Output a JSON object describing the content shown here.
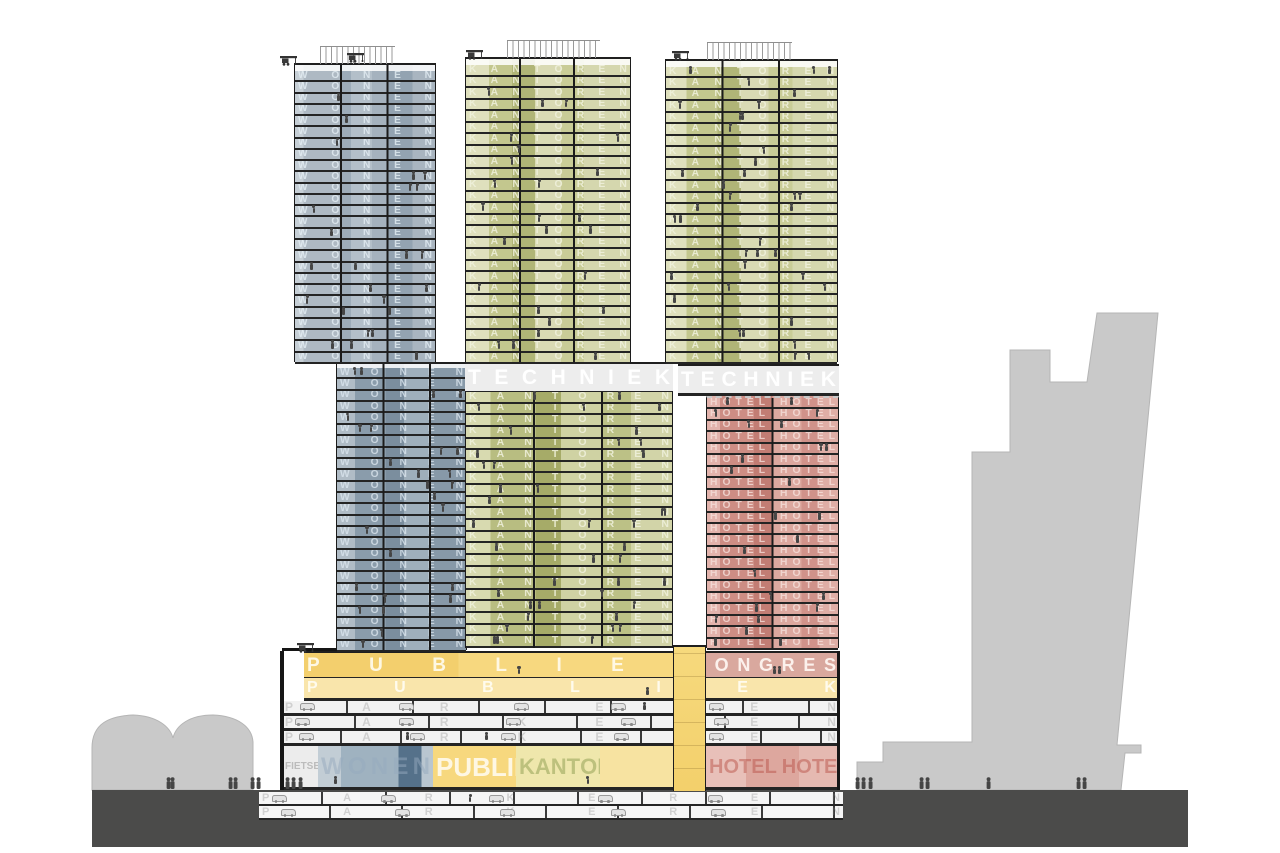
{
  "drawing": {
    "type": "architectural cross-section",
    "description": "Section through three-tower building on shared plinth with program labels"
  },
  "labels": {
    "wonen": "WONEN",
    "kantoren": "KANTOREN",
    "hotel": "HOTEL HOTEL",
    "techniek": "TECHNIEK",
    "publiek": "PUBLIEK",
    "congres": "CONGRES",
    "parkeren": "PARKEREN",
    "fietsen": "FIETSEN"
  },
  "colors": {
    "wonen_blue": "#aeb9c3",
    "kantoren_olive": "#c3c78e",
    "hotel_red": "#cd8d84",
    "techniek_grey": "#ededed",
    "publiek_yellow": "#f5d478",
    "congres_pink": "#d9a89e",
    "parking_grey": "#f2f2f2",
    "ground_dark": "#4b4b4a",
    "silhouette": "#c9c9c9",
    "figure": "#454545",
    "slab": "#242424"
  },
  "background": {
    "left_path": "M92,790 L92,748 C92,723 110,716 133,715 C158,716 170,727 173,738 C176,725 190,715 213,715 C238,716 252,727 253,742 L253,790 Z",
    "right_path": "M1010,350 L1050,350 L1050,382 L1087,382 L1097,313 L1158,313 L1117,745 L1141,745 L1141,753 L1125,753 L1121,790 L857,790 L857,762 L883,762 L883,742 L972,742 L972,452 L1010,452 Z"
  },
  "zones": [
    {
      "name": "ground-mass",
      "x": 92,
      "y": 790,
      "w": 1096,
      "h": 57,
      "bg": "#4b4b4a"
    },
    {
      "name": "basement-level-1",
      "x": 259,
      "y": 792,
      "w": 584,
      "h": 14,
      "floors": 1,
      "slab": 2,
      "bg": "repeating-linear-gradient(90deg,transparent 0 62px,#3a3a3a 62px 64px),linear-gradient(#f5f5f5,#f5f5f5)",
      "label": "parkeren",
      "fs": 11,
      "letterColor": "rgba(130,130,130,0.32)",
      "figMax": 1,
      "cars": true
    },
    {
      "name": "basement-level-2",
      "x": 259,
      "y": 806,
      "w": 584,
      "h": 14,
      "floors": 1,
      "slab": 2,
      "bg": "repeating-linear-gradient(90deg,transparent 0 70px,#3a3a3a 70px 72px),linear-gradient(#f5f5f5,#f5f5f5)",
      "label": "parkeren",
      "fs": 11,
      "letterColor": "rgba(130,130,130,0.32)",
      "figMax": 1,
      "cars": true
    },
    {
      "name": "plinth-publiek-floor-1",
      "x": 304,
      "y": 651,
      "w": 386,
      "h": 27,
      "floors": 1,
      "slab": 3,
      "roof": true,
      "bg": "linear-gradient(90deg,#f3cf6d 0 40%,#f7d87f 40% 100%)",
      "label": "publiek",
      "fs": 19,
      "letterColor": "rgba(255,252,240,0.9)",
      "figMax": 9
    },
    {
      "name": "plinth-congres-floor",
      "x": 690,
      "y": 651,
      "w": 149,
      "h": 27,
      "floors": 1,
      "slab": 3,
      "roof": true,
      "bg": "#d9a89e",
      "label": "congres",
      "fs": 18,
      "letterColor": "rgba(255,248,244,0.9)",
      "figMax": 5
    },
    {
      "name": "plinth-publiek-floor-2",
      "x": 304,
      "y": 678,
      "w": 535,
      "h": 23,
      "floors": 1,
      "slab": 3,
      "bg": "#f9e5ab",
      "label": "publiek",
      "fs": 16,
      "letterColor": "rgba(255,253,244,0.9)",
      "figMax": 10
    },
    {
      "name": "plinth-parking-level-1",
      "x": 282,
      "y": 701,
      "w": 557,
      "h": 15,
      "floors": 1,
      "slab": 3,
      "bg": "repeating-linear-gradient(90deg,transparent 0 64px,#3a3a3a 64px 66px),linear-gradient(#f2f2f2,#f2f2f2)",
      "label": "parkeren",
      "fs": 12,
      "letterColor": "rgba(130,130,130,0.3)",
      "figMax": 2,
      "cars": true
    },
    {
      "name": "plinth-parking-level-2",
      "x": 282,
      "y": 716,
      "w": 557,
      "h": 15,
      "floors": 1,
      "slab": 3,
      "bg": "repeating-linear-gradient(90deg,transparent 0 72px,#3a3a3a 72px 74px),linear-gradient(#f2f2f2,#f2f2f2)",
      "label": "parkeren",
      "fs": 12,
      "letterColor": "rgba(130,130,130,0.3)",
      "figMax": 2,
      "cars": true
    },
    {
      "name": "plinth-parking-level-3",
      "x": 282,
      "y": 731,
      "w": 557,
      "h": 15,
      "floors": 1,
      "slab": 3,
      "bg": "repeating-linear-gradient(90deg,transparent 0 58px,#3a3a3a 58px 60px),linear-gradient(#f2f2f2,#f2f2f2)",
      "label": "parkeren",
      "fs": 12,
      "letterColor": "rgba(130,130,130,0.3)",
      "figMax": 2,
      "cars": true
    },
    {
      "name": "ground-floor-fietsen",
      "x": 282,
      "y": 746,
      "w": 36,
      "h": 44,
      "floors": 1,
      "slab": 3,
      "bg": "#ececec",
      "label": "fietsen",
      "fs": 10,
      "letterColor": "rgba(130,130,130,0.45)",
      "figMax": 2
    },
    {
      "name": "ground-floor-wonen-lobby",
      "x": 318,
      "y": 746,
      "w": 115,
      "h": 44,
      "floors": 1,
      "slab": 3,
      "bg": "linear-gradient(90deg,#c2cdd5 0 20%,#9fb2c0 20% 70%,#55718a 70% 90%,#b9c6d0 90% 100%)",
      "label": "wonen",
      "fs": 24,
      "letterColor": "rgba(150,170,190,0.5)",
      "figMax": 3
    },
    {
      "name": "ground-floor-publiek",
      "x": 433,
      "y": 746,
      "w": 83,
      "h": 44,
      "floors": 1,
      "slab": 3,
      "bg": "#f7d87e",
      "label": "publiek",
      "fs": 26,
      "letterColor": "rgba(255,253,245,0.85)",
      "figMax": 3
    },
    {
      "name": "ground-floor-kantoren",
      "x": 516,
      "y": 746,
      "w": 84,
      "h": 44,
      "floors": 1,
      "slab": 3,
      "bg": "#efe7ac",
      "label": "kantoren",
      "fs": 22,
      "letterColor": "rgba(176,184,114,0.8)",
      "figMax": 3
    },
    {
      "name": "ground-floor-foyer",
      "x": 600,
      "y": 746,
      "w": 73,
      "h": 44,
      "floors": 1,
      "slab": 3,
      "bg": "#f7e3a1",
      "figMax": 3
    },
    {
      "name": "ground-floor-hotel",
      "x": 706,
      "y": 746,
      "w": 133,
      "h": 44,
      "floors": 1,
      "slab": 3,
      "bg": "linear-gradient(90deg,#e8c0b9 0 30%,#dda79e 30% 70%,#e5b9b1 70% 100%)",
      "label": "hotel",
      "fs": 20,
      "letterColor": "rgba(186,84,74,0.5)",
      "figMax": 4
    },
    {
      "name": "plinth-left-wall",
      "x": 280,
      "y": 651,
      "w": 4,
      "h": 139,
      "bg": "#161616"
    },
    {
      "name": "plinth-right-wall",
      "x": 837,
      "y": 651,
      "w": 3,
      "h": 139,
      "bg": "#161616"
    },
    {
      "name": "plinth-terrace-coping",
      "x": 282,
      "y": 648,
      "w": 56,
      "h": 3,
      "bg": "#151515"
    },
    {
      "name": "atrium-shaft",
      "x": 673,
      "y": 645,
      "w": 33,
      "h": 146,
      "borderX": true,
      "roof": true,
      "bg": "repeating-linear-gradient(0deg,transparent 0 22px,rgba(120,90,30,0.25) 22px 23px),linear-gradient(#f6d97d,#f3d06b)"
    },
    {
      "name": "tower-wonen-lower",
      "x": 336,
      "y": 362,
      "w": 131,
      "h": 288,
      "floors": 25,
      "slab": 2,
      "borderX": true,
      "roof": true,
      "mullions": [
        36,
        72
      ],
      "parapet": 4,
      "bg": "linear-gradient(90deg,#b0bcc6 0 14%,#8a9cab 14% 38%,#7b8e9e 38% 52%,#9fafbb 52% 72%,#8799a8 72% 100%)",
      "label": "wonen",
      "letterColor": "rgba(222,232,240,0.75)",
      "figMax": 2
    },
    {
      "name": "techniek-band-mid",
      "x": 465,
      "y": 362,
      "w": 208,
      "h": 30,
      "floors": 1,
      "slab": 3,
      "roof": true,
      "bg": "#ededed",
      "label": "techniek",
      "fs": 21,
      "letterColor": "#ffffff",
      "figMax": 0
    },
    {
      "name": "tower-kantoren-lower",
      "x": 465,
      "y": 392,
      "w": 208,
      "h": 256,
      "floors": 22,
      "slab": 2,
      "borderX": true,
      "mullions": [
        33,
        66
      ],
      "bg": "linear-gradient(90deg,#d8dab0 0 12%,#b8bd81 12% 34%,#a6ab68 34% 46%,#cfd2a3 46% 66%,#bcc186 66% 80%,#d2d4a8 80% 100%)",
      "label": "kantoren",
      "letterColor": "rgba(240,241,221,0.85)",
      "figMax": 3
    },
    {
      "name": "techniek-band-right",
      "x": 678,
      "y": 364,
      "w": 161,
      "h": 30,
      "floors": 1,
      "slab": 3,
      "roof": true,
      "bg": "#ededed",
      "label": "techniek",
      "fs": 21,
      "letterColor": "#ffffff",
      "figMax": 0
    },
    {
      "name": "tower-hotel-lower",
      "x": 706,
      "y": 396,
      "w": 133,
      "h": 252,
      "floors": 22,
      "slab": 2,
      "borderX": true,
      "mullions": [
        50
      ],
      "dashedTop": true,
      "bg": "linear-gradient(90deg,#e2b3ac 0 10%,#cd8d84 10% 36%,#c27d74 36% 50%,#dca89f 50% 72%,#d0928a 72% 86%,#dfaea6 86% 100%)",
      "label": "hotel",
      "letterColor": "rgba(245,223,218,0.8)",
      "figMax": 2
    },
    {
      "name": "tower-wonen-upper",
      "x": 294,
      "y": 63,
      "w": 142,
      "h": 299,
      "floors": 26,
      "slab": 2,
      "borderX": true,
      "roof": true,
      "mullions": [
        33,
        66
      ],
      "parapet": 6,
      "bg": "linear-gradient(90deg,#c6cfd6 0 6%,#aeb9c3 6% 32%,#9dacb9 32% 40%,#b3bfc9 40% 55%,#a5b2be 55% 66%,#93a3b1 66% 84%,#a9b5c0 84% 100%)",
      "label": "wonen",
      "letterColor": "rgba(228,237,244,0.8)",
      "figMax": 2
    },
    {
      "name": "tower-kantoren-upper-mid",
      "x": 465,
      "y": 57,
      "w": 166,
      "h": 305,
      "floors": 26,
      "slab": 2,
      "borderX": true,
      "roof": true,
      "mullions": [
        33,
        66
      ],
      "parapet": 6,
      "bg": "linear-gradient(90deg,#dfe0bd 0 14%,#c3c78e 14% 28%,#b0b577 28% 42%,#d9dab4 42% 58%,#c9cc97 58% 72%,#d5d7ae 72% 100%)",
      "label": "kantoren",
      "letterColor": "rgba(240,241,221,0.85)",
      "figMax": 2
    },
    {
      "name": "tower-kantoren-upper-right",
      "x": 665,
      "y": 59,
      "w": 173,
      "h": 303,
      "floors": 26,
      "slab": 2,
      "borderX": true,
      "roof": true,
      "mullions": [
        33,
        66
      ],
      "parapet": 6,
      "bg": "linear-gradient(90deg,#dfe0bd 0 12%,#c3c78e 12% 30%,#b0b577 30% 44%,#d9dab4 44% 60%,#c9cc97 60% 74%,#d5d7ae 74% 100%)",
      "label": "kantoren",
      "letterColor": "rgba(240,241,221,0.85)",
      "figMax": 3
    }
  ],
  "roof_screens": [
    {
      "x": 320,
      "y": 46,
      "w": 75
    },
    {
      "x": 507,
      "y": 40,
      "w": 93
    },
    {
      "x": 707,
      "y": 42,
      "w": 85
    }
  ],
  "cranes": [
    {
      "x": 347,
      "y": 49
    },
    {
      "x": 466,
      "y": 46
    },
    {
      "x": 672,
      "y": 47
    },
    {
      "x": 297,
      "y": 639
    },
    {
      "x": 280,
      "y": 52
    }
  ],
  "ground_figures": [
    167,
    171,
    229,
    234,
    251,
    257,
    286,
    292,
    299,
    856,
    862,
    869,
    920,
    926,
    987,
    1077,
    1083
  ]
}
